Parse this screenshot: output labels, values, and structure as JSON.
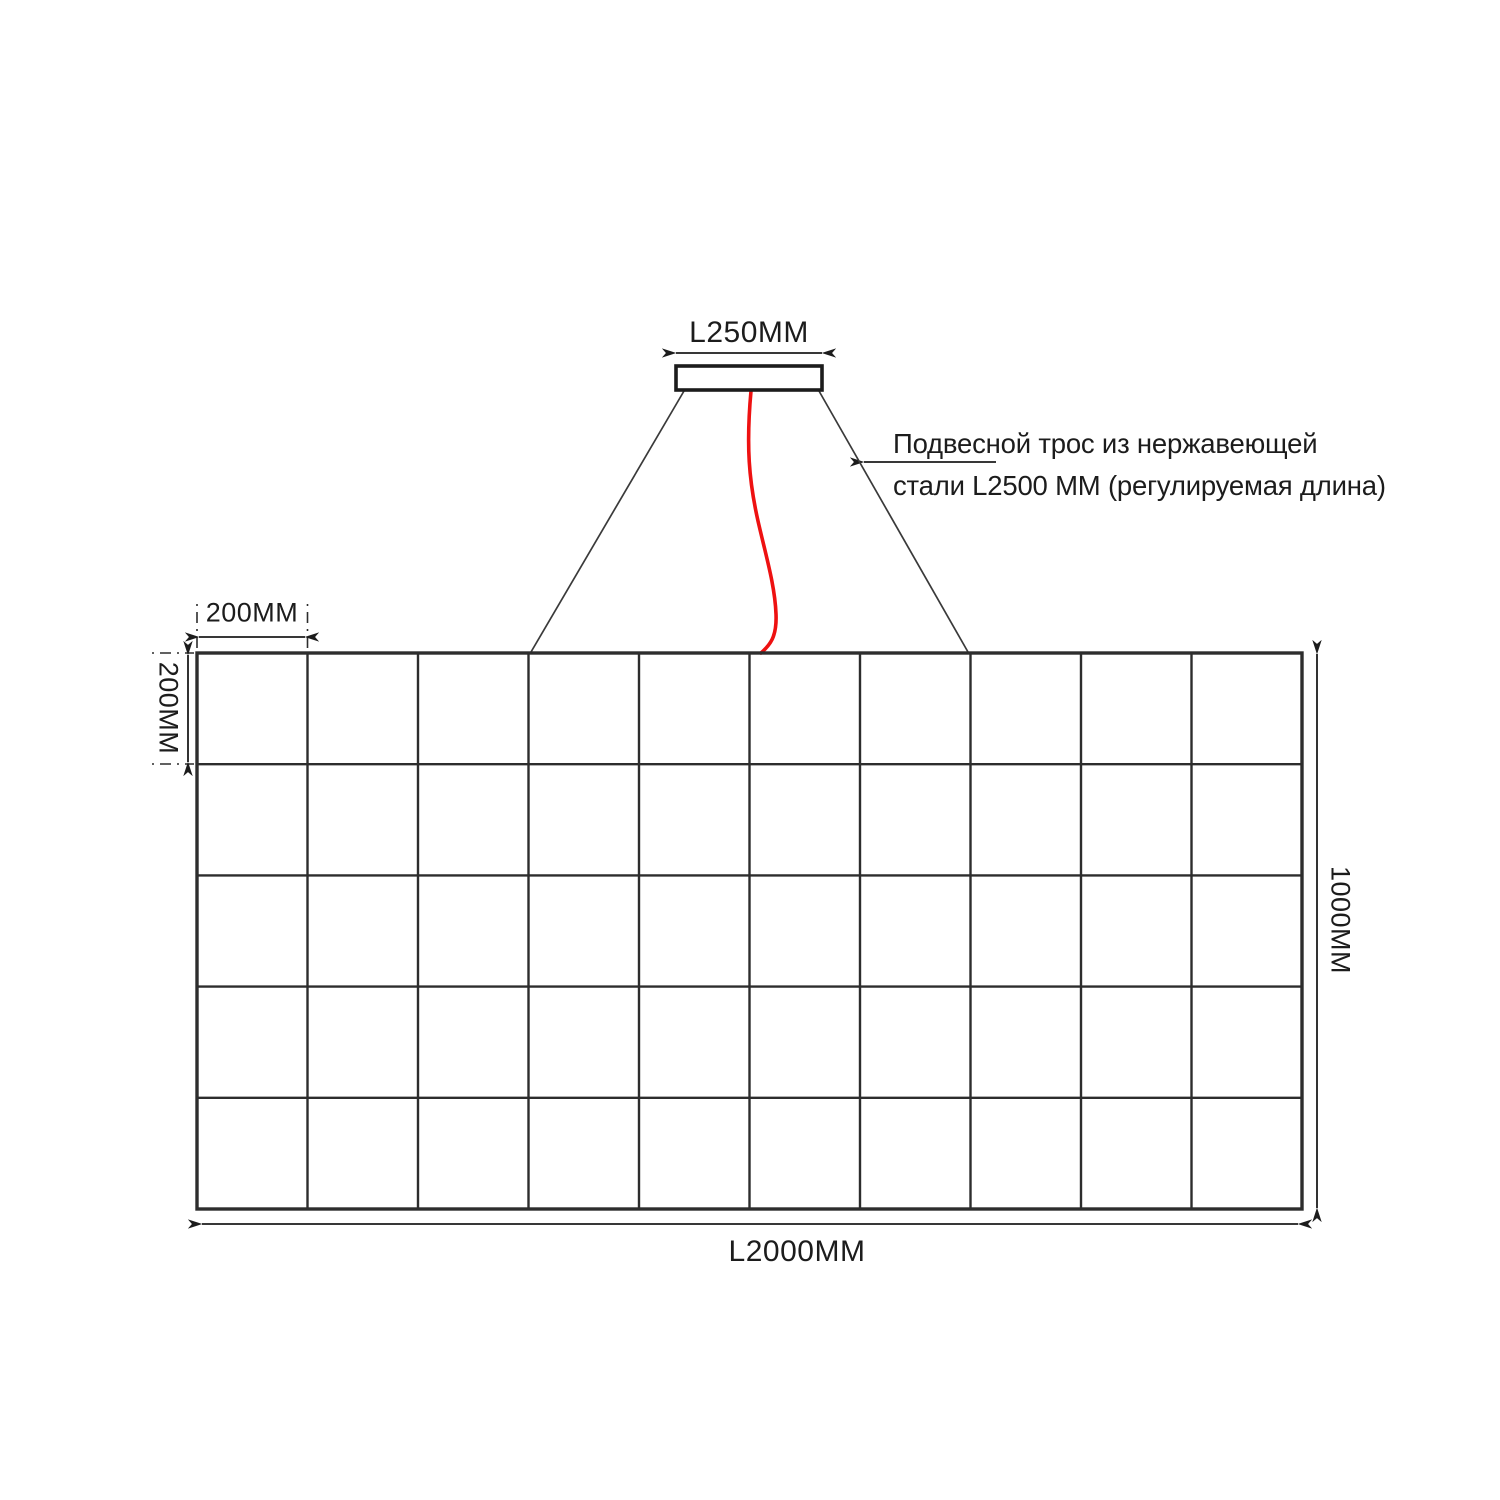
{
  "diagram": {
    "type": "technical-drawing",
    "subject": "suspended-grid-lamp-installation",
    "grid": {
      "columns": 10,
      "rows": 5
    },
    "dimensions": {
      "mount_width_label": "L250MM",
      "cell_width_label": "200MM",
      "cell_height_label": "200MM",
      "total_height_label": "1000MM",
      "total_width_label": "L2000MM"
    },
    "annotation": {
      "line1": "Подвесной трос из нержавеющей",
      "line2": "стали L2500 ММ (регулируемая длина)"
    },
    "colors": {
      "line": "#2d2d2d",
      "thin_line": "#3a3a3a",
      "cable": "#ee1111",
      "background": "#ffffff"
    }
  }
}
